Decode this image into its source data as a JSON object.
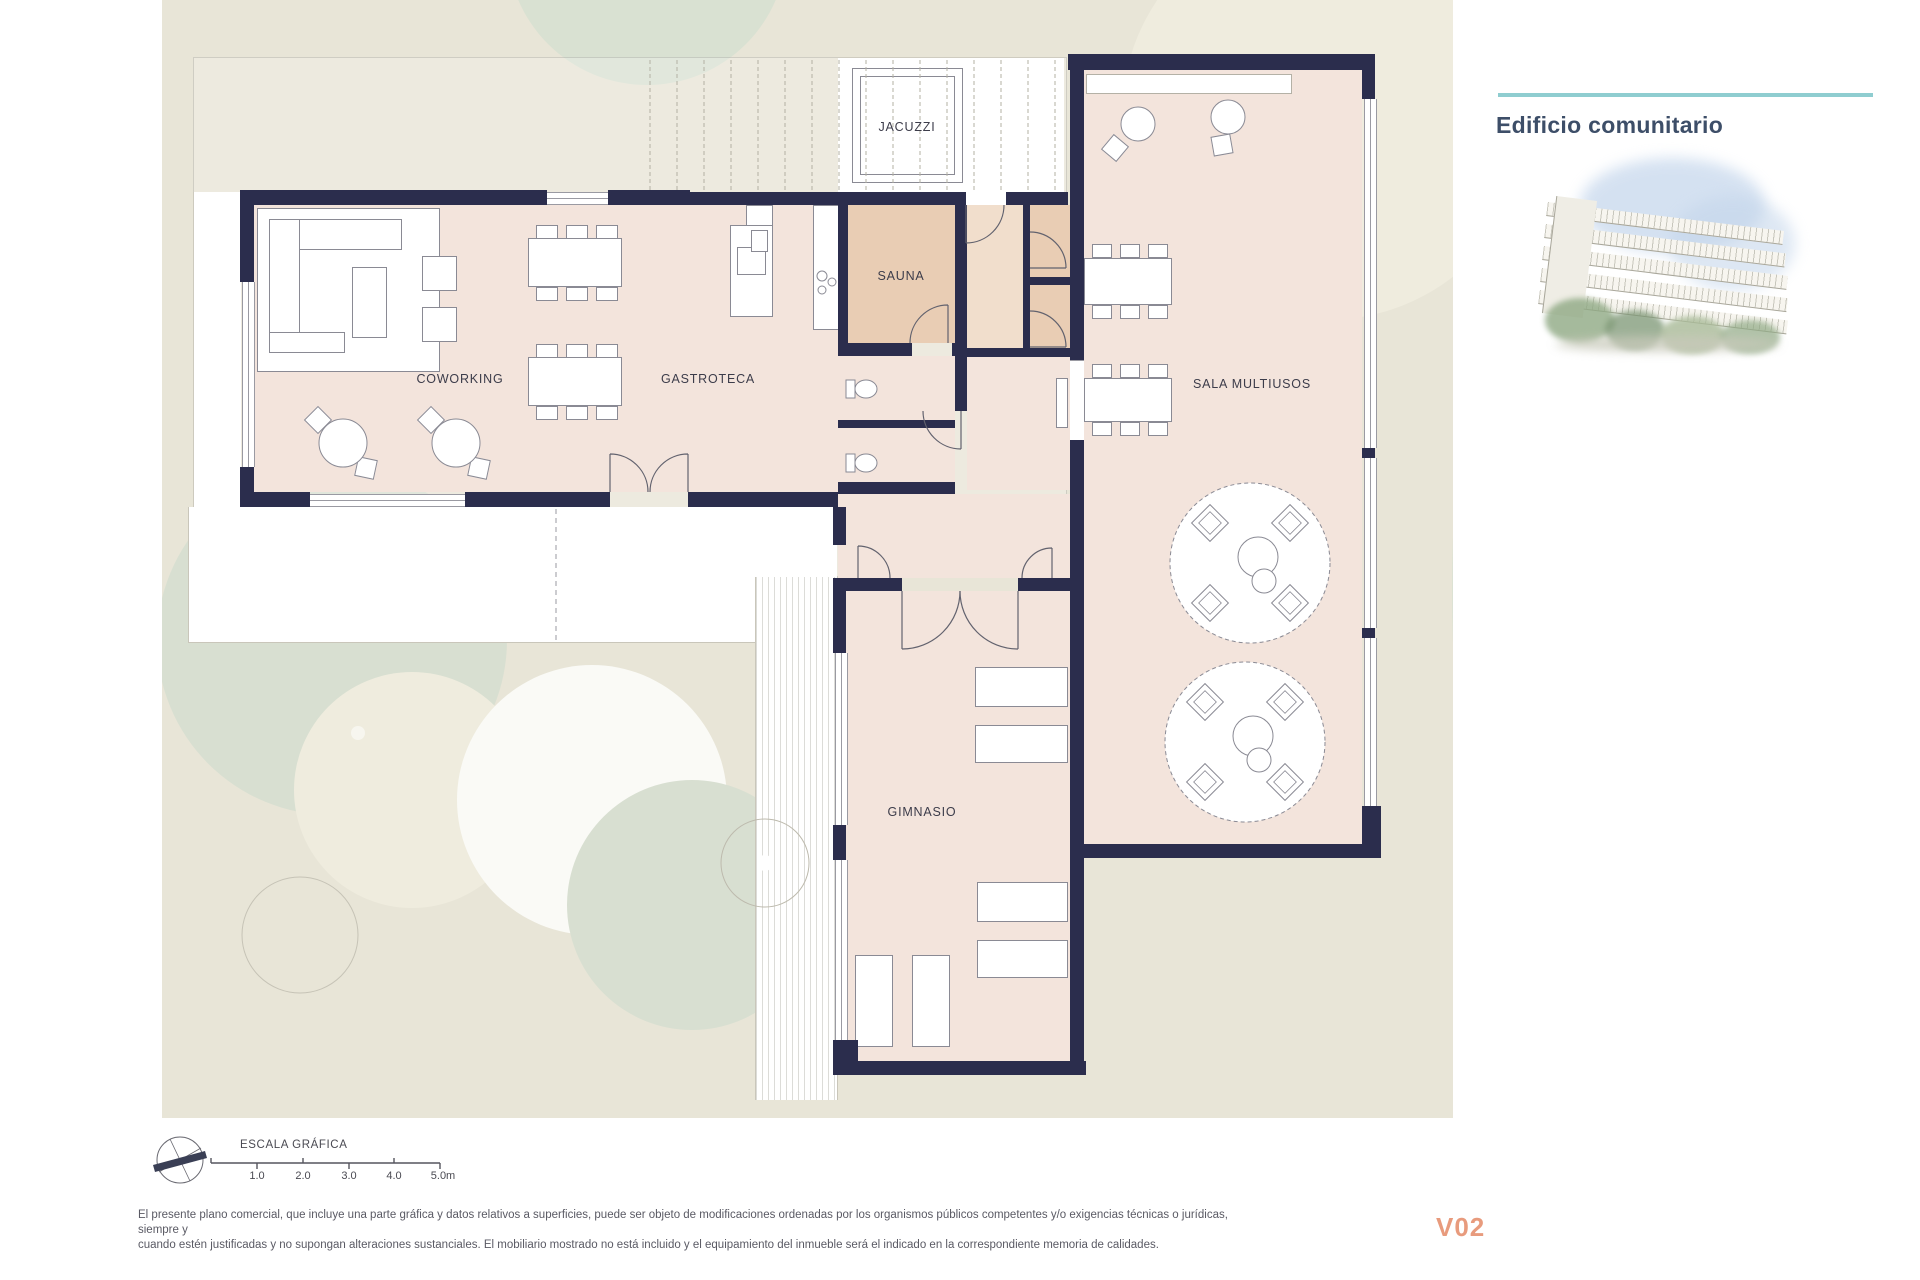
{
  "header": {
    "title": "Edificio comunitario",
    "accent_color": "#8FCDD0",
    "title_color": "#3D4E68"
  },
  "plan": {
    "rooms": [
      {
        "id": "jacuzzi",
        "label": "JACUZZI"
      },
      {
        "id": "sauna",
        "label": "SAUNA"
      },
      {
        "id": "coworking",
        "label": "COWORKING"
      },
      {
        "id": "gastroteca",
        "label": "GASTROTECA"
      },
      {
        "id": "sala-multiusos",
        "label": "SALA MULTIUSOS"
      },
      {
        "id": "gimnasio",
        "label": "GIMNASIO"
      }
    ],
    "colors": {
      "wall": "#2B2D4D",
      "room_fill": "#F3E4DC",
      "wet_room_fill": "#E9CDB4",
      "landscape": "#E8E5D7"
    }
  },
  "scale_bar": {
    "title": "ESCALA GRÁFICA",
    "ticks": [
      "1.0",
      "2.0",
      "3.0",
      "4.0",
      "5.0m"
    ]
  },
  "footer": {
    "disclaimer_line1": "El presente plano comercial, que incluye una parte gráfica y datos relativos a superficies, puede ser objeto de modificaciones ordenadas por los organismos públicos competentes y/o exigencias técnicas o jurídicas, siempre y",
    "disclaimer_line2": "cuando estén justificadas y no supongan alteraciones sustanciales. El mobiliario mostrado no está incluido y el equipamiento del inmueble será el indicado en la correspondiente memoria de calidades.",
    "version": "V02",
    "version_color": "#E89B7D"
  }
}
